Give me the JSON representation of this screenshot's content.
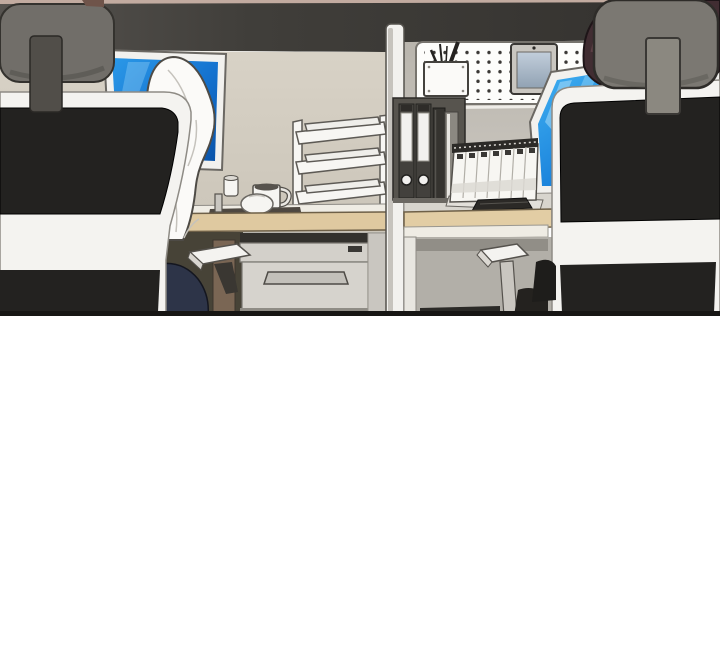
{
  "scene": {
    "kind": "comic-panel-office-cubicles",
    "objects": [
      "left-office-chair",
      "left-chair-headrest",
      "white-jacket-draped-on-chair",
      "left-monitor",
      "paper-tray-organizer",
      "mug",
      "mouse",
      "desk-mat",
      "desk-gadget",
      "left-desk",
      "drawer-unit",
      "left-armrest",
      "cubicle-partition-pole",
      "pegboard",
      "pencil-box",
      "pens",
      "wall-tablet",
      "binders",
      "file-book",
      "document-folder",
      "flip-desk-calendar",
      "keyboard",
      "right-desk",
      "right-armrest",
      "right-monitor",
      "right-office-chair",
      "right-chair-headrest",
      "coworker-hair"
    ]
  },
  "colors": {
    "page_bg": "#ffffff",
    "top_strip": "#c2aba0",
    "band_light": "#56534f",
    "band_mid": "#403e3a",
    "band_dark": "#33312e",
    "band_highlight": "#f0eee9",
    "wall_left_top": "#d8d2c6",
    "wall_left_bottom": "#cbc5b9",
    "wall_right_top": "#b9b5ad",
    "wall_right_bottom": "#cdc9c2",
    "screen_left_a": "#2b99e8",
    "screen_left_b": "#1472cf",
    "screen_left_c": "#0a53a8",
    "screen_right_a": "#41b1f2",
    "screen_right_b": "#1d86dd",
    "screen_right_c": "#1165bf",
    "bezel_white": "#f2f1ee",
    "wood": "#dfc9a0",
    "wood_right": "#e2cda4",
    "desk_lip": "#efece4",
    "surface_right": "#d8d5ce",
    "mat_dark": "#4e4841",
    "tray_white": "#f7f6f3",
    "mug_white": "#f6f5f2",
    "jacket_white": "#fbfaf8",
    "chair_black": "#232220",
    "chair_frame": "#f4f3f0",
    "headrest_left": "#716e69",
    "headrest_right": "#7b7872",
    "stem_left": "#514e49",
    "stem_right": "#8b8880",
    "hair_left_tuft": "#6f544a",
    "hair_right": "#412d32",
    "underdesk_left": "#b7b4ad",
    "underdesk_dark": "#474337",
    "underdesk_right": "#b2afa8",
    "shadow_band": "#918e87",
    "brown_strip": "#7a6654",
    "navy_pants": "#2d3448",
    "drawer_face": "#d6d3cd",
    "drawer_top": "#d3d0ca",
    "handle_fill": "#c3c0ba",
    "pole_white": "#f2f1ee",
    "pole_shade": "#c6c3bd",
    "pegboard_white": "#fdfdfb",
    "tablet_frame": "#c9c6c0",
    "binder_container": "#57544e",
    "binder_dark": "#43413d",
    "binder_label": "#f2f1ef",
    "book_dark": "#35332f",
    "folder_gray": "#8b8881",
    "calendar_white": "#f7f6f2",
    "calendar_base": "#e3e0da",
    "spiral_dark": "#2c2a27",
    "keyboard_black": "#2b2926",
    "armrest_white": "#f4f3f0",
    "armrest_post": "#c9c6c0",
    "floor_slab": "#2b2a27",
    "leg_blob": "#24221f",
    "panel_border": "#171614"
  }
}
